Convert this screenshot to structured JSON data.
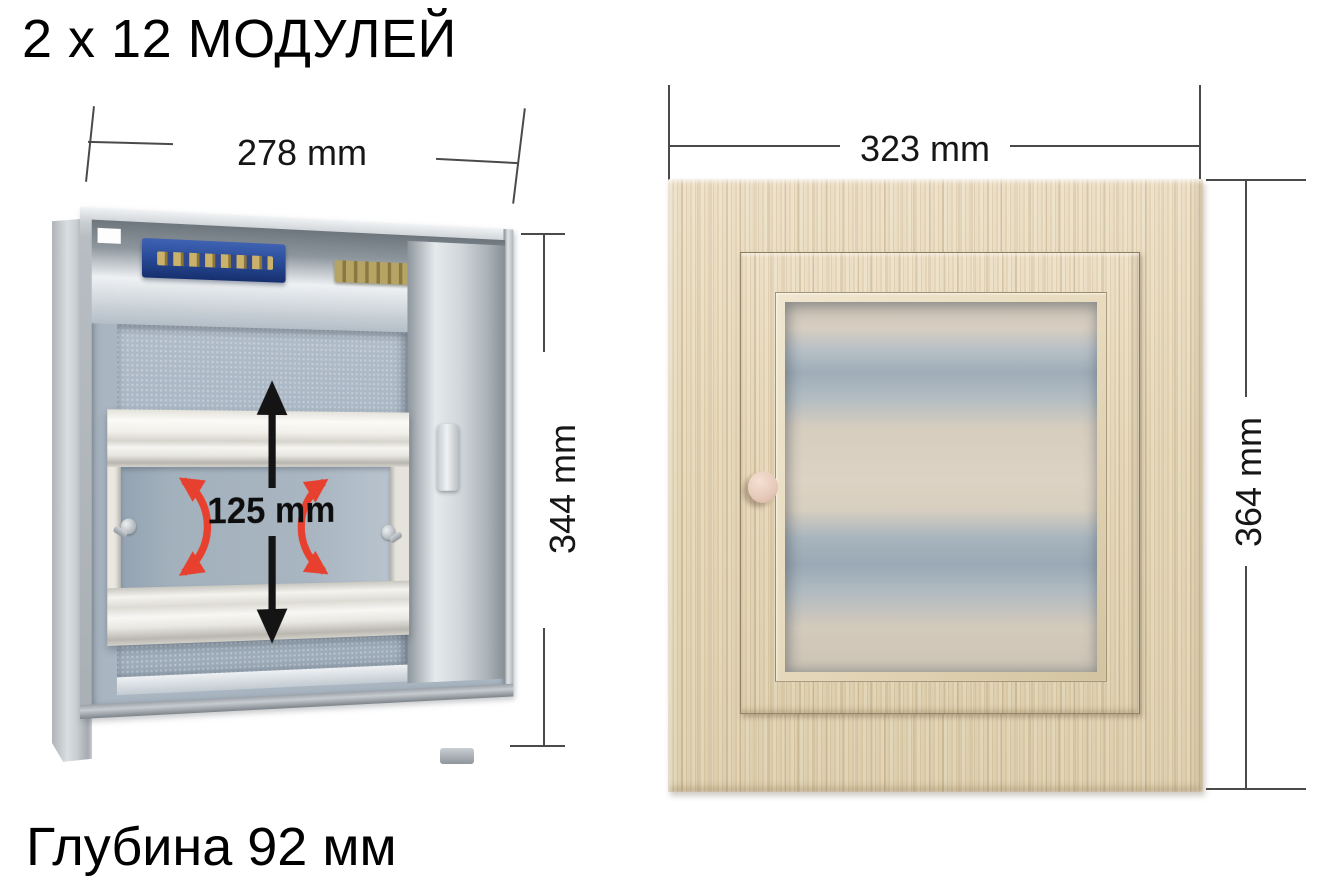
{
  "header": {
    "title": "2 x 12 МОДУЛЕЙ"
  },
  "footer": {
    "caption": "Глубина 92 мм"
  },
  "left_view": {
    "width_dim": "278 mm",
    "height_dim": "344 mm",
    "rail_travel_dim": "125 mm"
  },
  "right_view": {
    "width_dim": "323 mm",
    "height_dim": "364 mm"
  },
  "icons": {
    "rail_travel_up": "arrow-up-icon",
    "rail_travel_down": "arrow-down-icon",
    "rail_swing_left": "curved-rotation-arrow-icon",
    "rail_swing_right": "curved-rotation-arrow-icon"
  },
  "colors": {
    "background": "#ffffff",
    "text": "#111111",
    "dimension_line": "#4a4a4a",
    "red_arrow": "#e8402e",
    "terminal_blue": "#2a4c9b",
    "brass_bar": "#ab9858",
    "metal_interior": "#a9b6c2",
    "wood_base": "#e4d7ba"
  }
}
